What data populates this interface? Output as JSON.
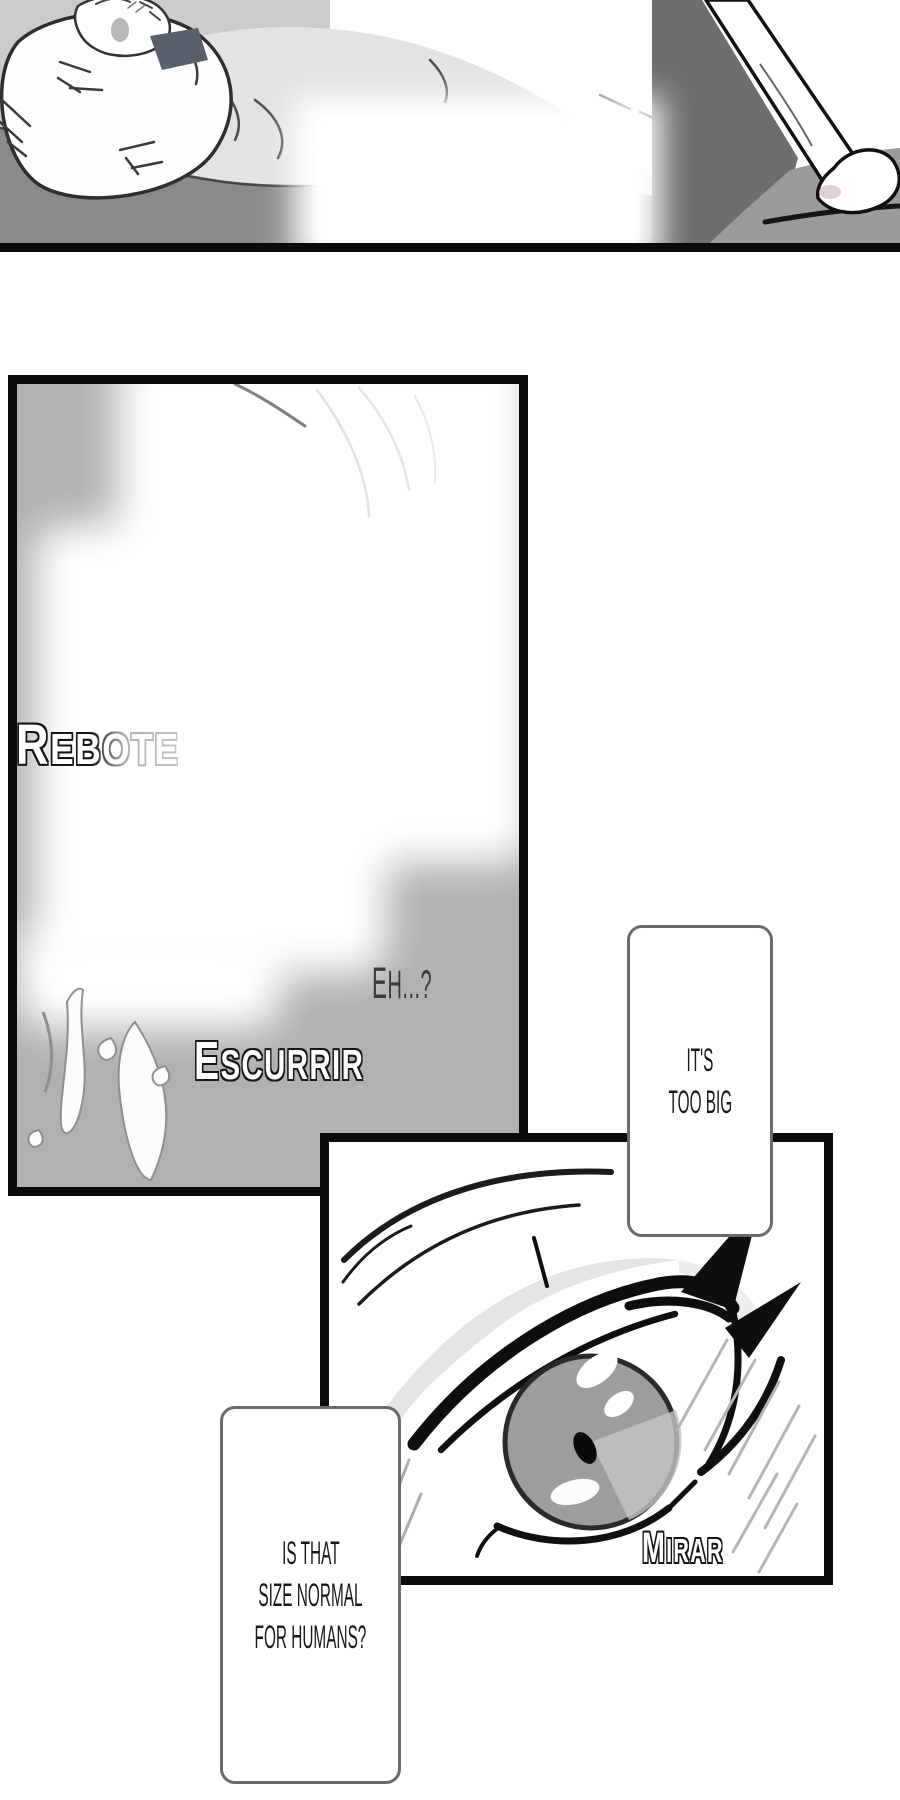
{
  "comic": {
    "panel_middle": {
      "sfx_rebote": "Rebote",
      "sfx_eh": "Eh...?",
      "sfx_escurrir": "Escurrir"
    },
    "panel_eye": {
      "sfx_mirar": "Mirar"
    },
    "bubbles": {
      "b1": {
        "lines": [
          "It's",
          "too big"
        ]
      },
      "b2": {
        "lines": [
          "Is that",
          "size normal",
          "for humans?"
        ]
      }
    },
    "palette": {
      "panel_border": "#0c0c0c",
      "panel_gray": "#b1b1b1",
      "bed_gray": "#8a8a8a",
      "background_light_gray": "#cbcbcb",
      "dark_wedge_gray": "#6e6e6e",
      "floor_gray": "#9b9b9b",
      "bubble_border": "#6a6a6a",
      "text_dark": "#191919",
      "sfx_fill": "#ffffff",
      "iris_gray": "#9d9d9d"
    }
  }
}
